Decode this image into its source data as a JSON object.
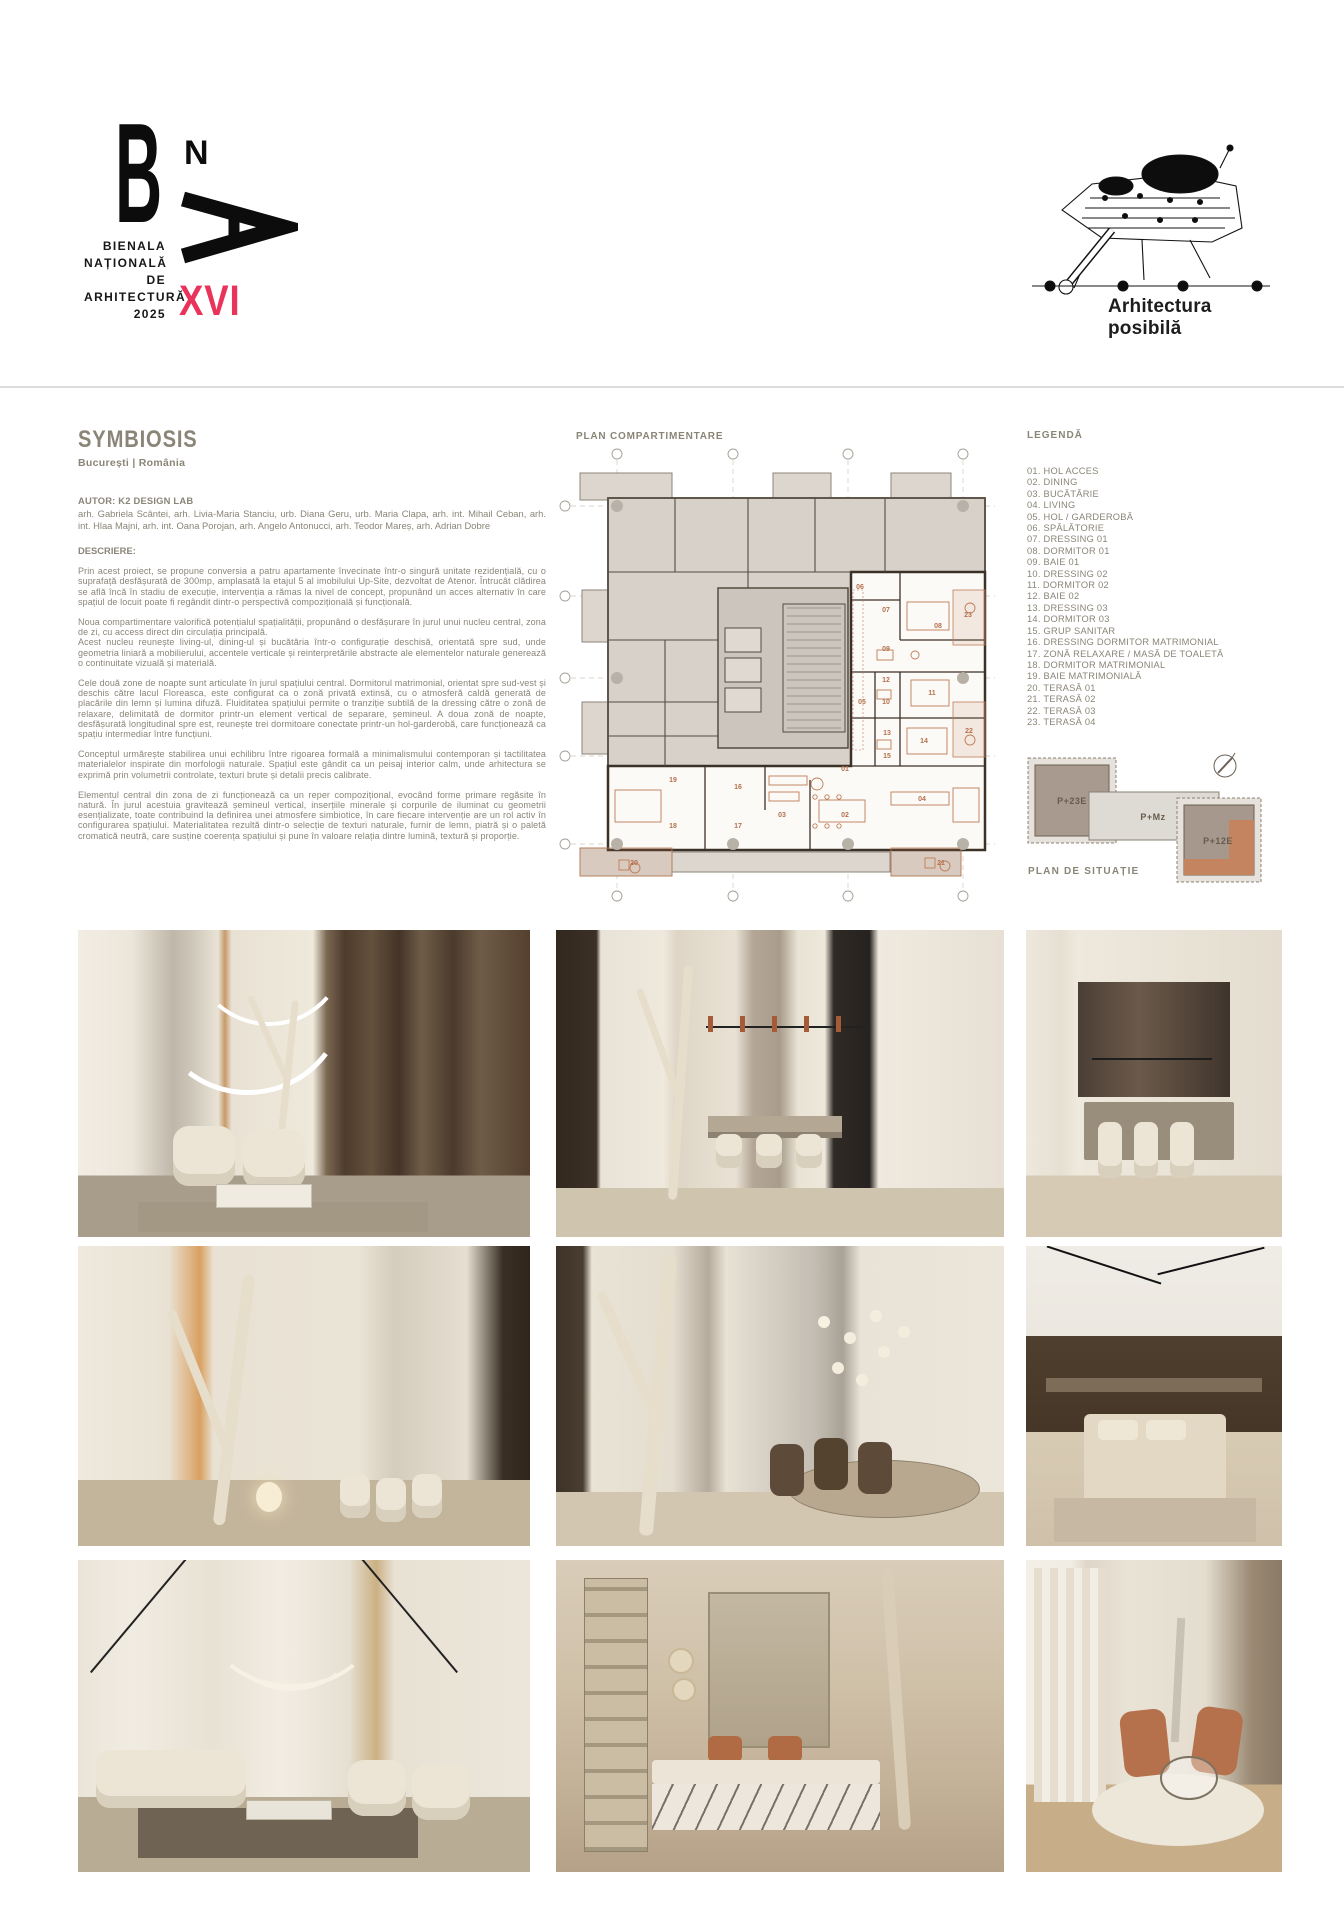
{
  "header": {
    "logo": {
      "letter_b": "B",
      "letter_n": "N",
      "caption_lines": [
        "BIENALA",
        "NAȚIONALĂ",
        "DE",
        "ARHITECTURĂ",
        "2025"
      ],
      "edition": "XVI"
    },
    "tagline": "Arhitectura posibilă"
  },
  "project": {
    "title": "SYMBIOSIS",
    "location": "București | România",
    "author_label": "AUTOR: K2 DESIGN LAB",
    "authors": "arh. Gabriela Scântei, arh. Livia-Maria Stanciu, urb. Diana Geru, urb. Maria Clapa, arh. int. Mihail Ceban, arh. int. Hlaa Majni, arh. int. Oana Porojan, arh. Angelo Antonucci, arh. Teodor Mareș, arh. Adrian Dobre",
    "description_label": "DESCRIERE:",
    "paragraphs": [
      "Prin acest proiect, se propune conversia a patru apartamente învecinate într-o singură unitate rezidențială, cu o suprafață desfășurată de 300mp, amplasată la etajul 5 al imobilului Up-Site, dezvoltat de Atenor. Întrucât clădirea se află încă în stadiu de execuție, intervenția a rămas la nivel de concept, propunând un acces alternativ în care spațiul de locuit poate fi regândit dintr-o perspectivă compozițională și funcțională.",
      "Noua compartimentare valorifică potențialul spațialității, propunând o desfășurare în jurul unui nucleu central, zona de zi, cu access direct din circulația principală.\nAcest nucleu reunește living-ul, dining-ul și bucătăria într-o configurație deschisă, orientată spre sud, unde geometria liniară a mobilierului, accentele verticale și reinterpretările abstracte ale elementelor naturale generează o continuitate vizuală și materială.",
      "Cele două zone de noapte sunt articulate în jurul spațiului central. Dormitorul matrimonial, orientat spre sud-vest și deschis către lacul Floreasca, este configurat ca o zonă privată extinsă, cu o atmosferă caldă generată de placările din lemn și lumina difuză. Fluiditatea spațiului permite o tranziție subtilă de la dressing către o zonă de relaxare, delimitată de dormitor printr-un element vertical de separare, șemineul. A doua zonă de noapte, desfășurată longitudinal spre est, reunește trei dormitoare conectate printr-un hol-garderobă, care funcționează ca spațiu intermediar între funcțiuni.",
      "Conceptul urmărește stabilirea unui echilibru între rigoarea formală a minimalismului contemporan și tactilitatea materialelor inspirate din morfologii naturale. Spațiul este gândit ca un peisaj interior calm, unde arhitectura se exprimă prin volumetrii controlate, texturi brute și detalii precis calibrate.",
      "Elementul central din zona de zi funcționează ca un reper compozițional, evocând forme primare regăsite în natură. În jurul acestuia gravitează șemineul vertical, inserțiile minerale și corpurile de iluminat cu geometrii esențializate, toate contribuind la definirea unei atmosfere simbiotice, în care fiecare intervenție are un rol activ în configurarea spațiului. Materialitatea rezultă dintr-o selecție de texturi naturale, furnir de lemn, piatră și o paletă cromatică neutră, care susține coerența spațiului și pune în valoare relația dintre lumină, textură și proporție."
    ]
  },
  "plan": {
    "title": "PLAN COMPARTIMENTARE",
    "room_labels": [
      {
        "x": 290,
        "y": 331,
        "t": "01"
      },
      {
        "x": 290,
        "y": 377,
        "t": "02"
      },
      {
        "x": 227,
        "y": 377,
        "t": "03"
      },
      {
        "x": 367,
        "y": 361,
        "t": "04"
      },
      {
        "x": 307,
        "y": 264,
        "t": "05"
      },
      {
        "x": 305,
        "y": 149,
        "t": "06"
      },
      {
        "x": 331,
        "y": 172,
        "t": "07"
      },
      {
        "x": 383,
        "y": 188,
        "t": "08"
      },
      {
        "x": 331,
        "y": 211,
        "t": "09"
      },
      {
        "x": 331,
        "y": 264,
        "t": "10"
      },
      {
        "x": 377,
        "y": 255,
        "t": "11"
      },
      {
        "x": 331,
        "y": 242,
        "t": "12"
      },
      {
        "x": 332,
        "y": 295,
        "t": "13"
      },
      {
        "x": 369,
        "y": 303,
        "t": "14"
      },
      {
        "x": 332,
        "y": 318,
        "t": "15"
      },
      {
        "x": 183,
        "y": 349,
        "t": "16"
      },
      {
        "x": 183,
        "y": 388,
        "t": "17"
      },
      {
        "x": 118,
        "y": 388,
        "t": "18"
      },
      {
        "x": 118,
        "y": 342,
        "t": "19"
      },
      {
        "x": 79,
        "y": 425,
        "t": "20"
      },
      {
        "x": 386,
        "y": 425,
        "t": "21"
      },
      {
        "x": 414,
        "y": 293,
        "t": "22"
      },
      {
        "x": 413,
        "y": 177,
        "t": "23"
      }
    ]
  },
  "legend": {
    "title": "LEGENDĂ",
    "items": [
      "01. HOL ACCES",
      "02. DINING",
      "03. BUCĂTĂRIE",
      "04. LIVING",
      "05. HOL / GARDEROBĂ",
      "06. SPĂLĂTORIE",
      "07. DRESSING 01",
      "08. DORMITOR 01",
      "09. BAIE 01",
      "10. DRESSING 02",
      "11. DORMITOR 02",
      "12. BAIE 02",
      "13. DRESSING 03",
      "14. DORMITOR 03",
      "15. GRUP SANITAR",
      "16. DRESSING DORMITOR MATRIMONIAL",
      "17. ZONĂ RELAXARE  / MASĂ DE TOALETĂ",
      "18. DORMITOR MATRIMONIAL",
      "19. BAIE MATRIMONIALĂ",
      "20. TERASĂ 01",
      "21. TERASĂ 02",
      "22. TERASĂ 03",
      "23. TERASĂ 04"
    ]
  },
  "site_plan": {
    "title": "PLAN DE SITUAȚIE",
    "b23": "P+23E",
    "bmz": "P+Mz",
    "b12": "P+12E"
  },
  "colors": {
    "accent_pink": "#E9335A",
    "text_olive": "#8A8577",
    "plan_orange": "#BF7C57",
    "plan_gray": "#D7D1CA"
  }
}
